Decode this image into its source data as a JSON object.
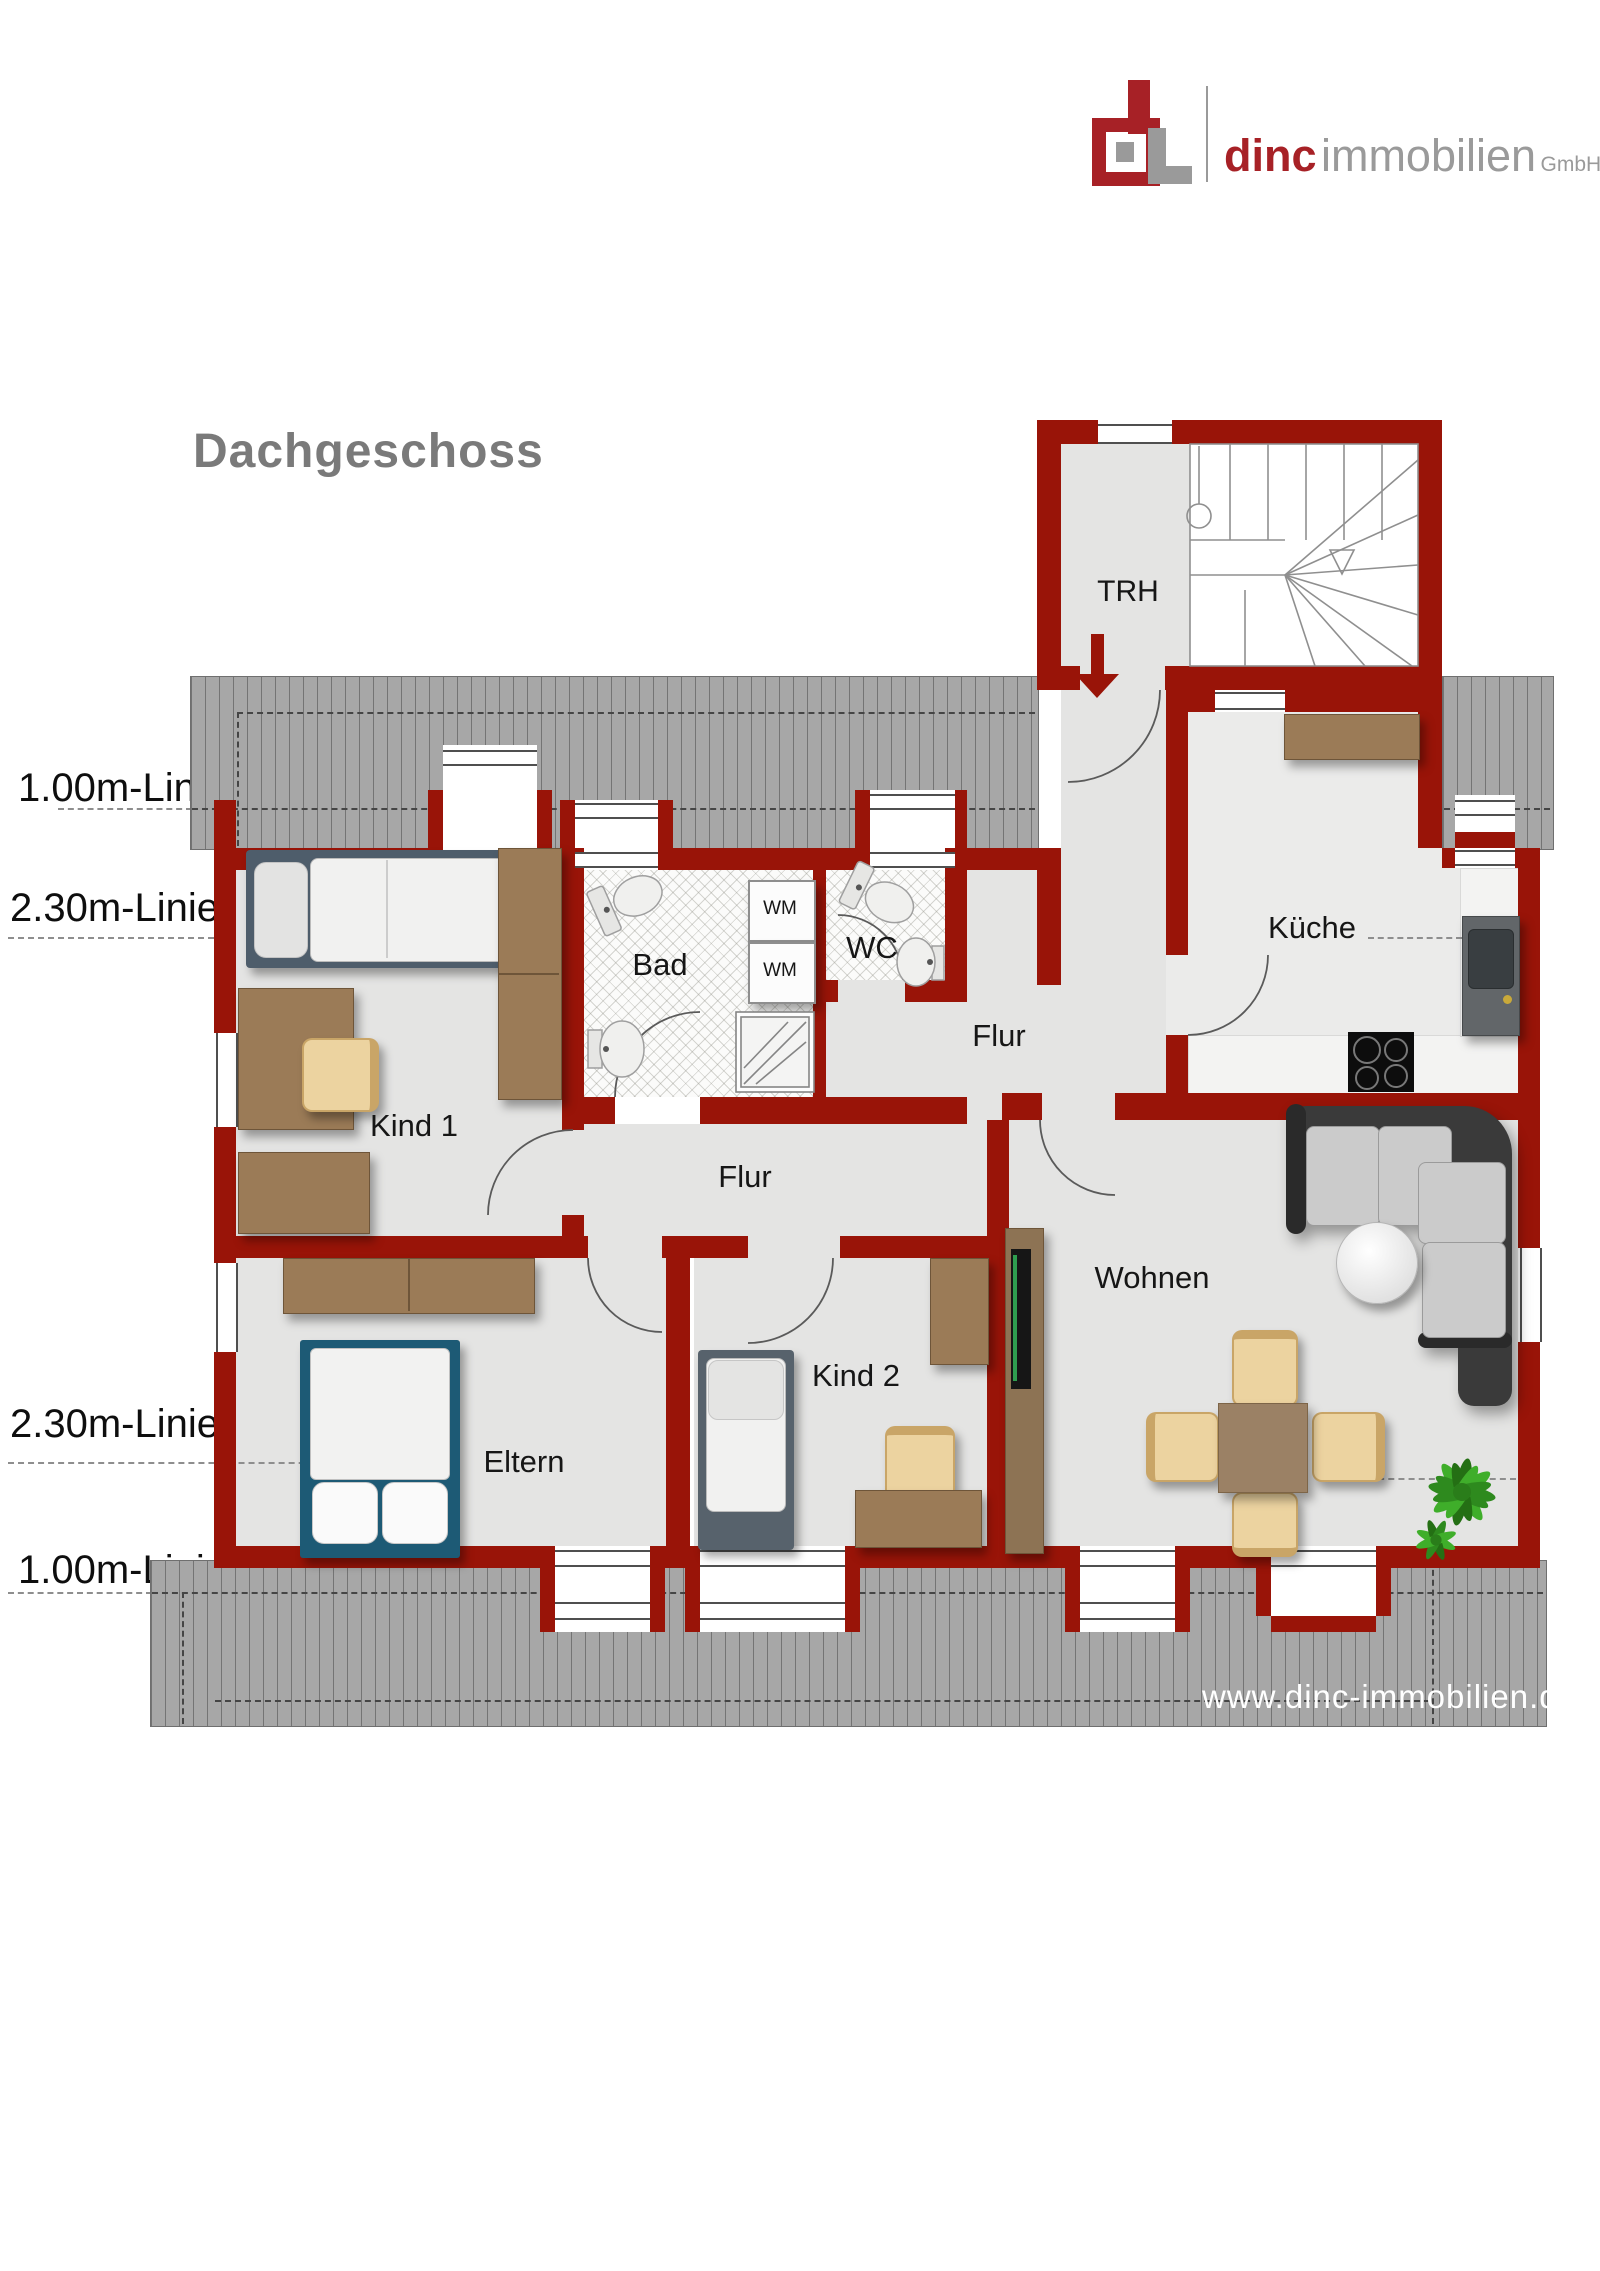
{
  "logo": {
    "brand": "dinc",
    "suffix": "immobilien",
    "legal": "GmbH"
  },
  "title": "Dachgeschoss",
  "website": "www.dinc-immobilien.de",
  "dimension_lines": {
    "top_100": "1.00m-Linie",
    "top_230": "2.30m-Linie",
    "bottom_230": "2.30m-Linie",
    "bottom_100": "1.00m-Linie"
  },
  "rooms": {
    "trh": "TRH",
    "bad": "Bad",
    "wc": "WC",
    "flur_top": "Flur",
    "flur_main": "Flur",
    "kueche": "Küche",
    "kind1": "Kind 1",
    "kind2": "Kind 2",
    "eltern": "Eltern",
    "wohnen": "Wohnen"
  },
  "appliances": {
    "wm_top": "WM",
    "wm_bottom": "WM"
  },
  "colors": {
    "wall_red": "#991408",
    "roof_gray": "#a7a7a7",
    "floor_gray": "#e4e4e3",
    "logo_red": "#a72126",
    "logo_gray": "#9a9a9a",
    "furniture_brown": "#9b7b57",
    "bed_blue": "#1d5a75"
  }
}
